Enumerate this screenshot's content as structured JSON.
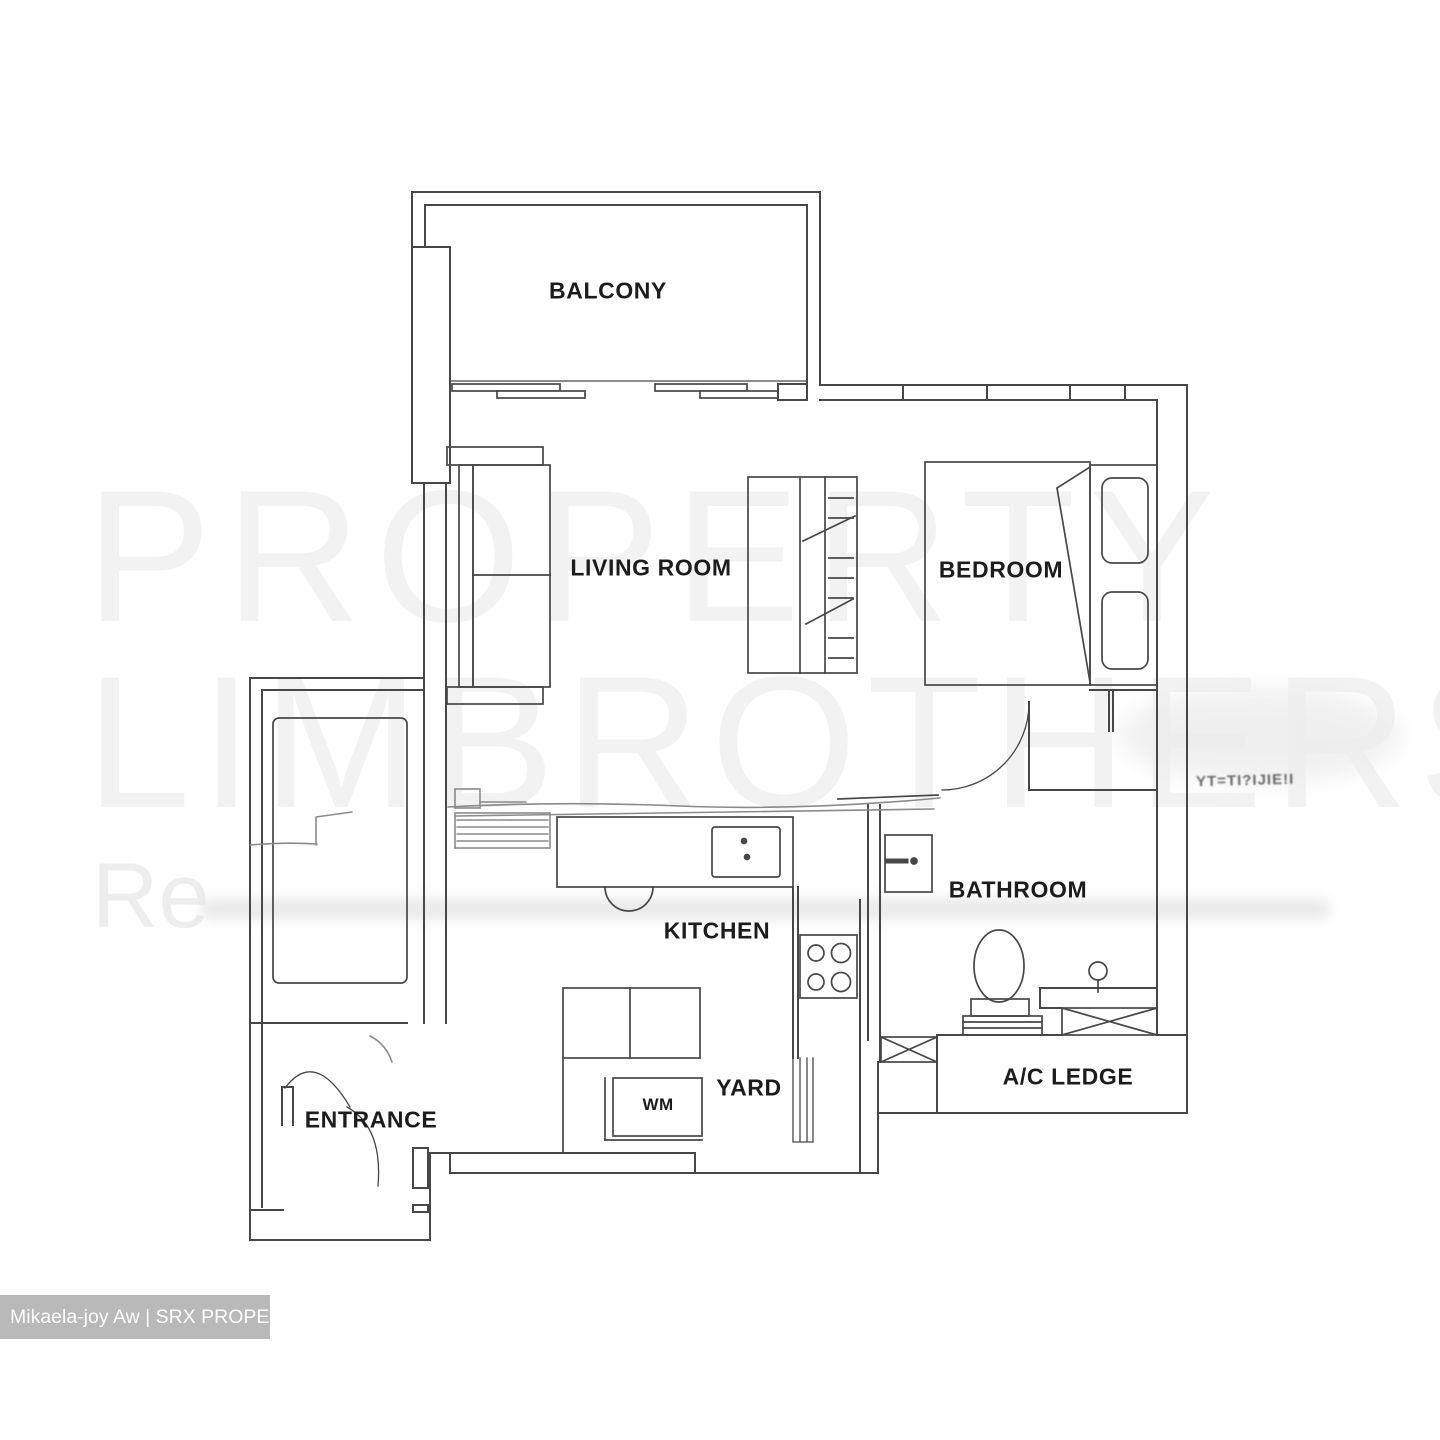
{
  "watermark": {
    "line1": "PROPERTY",
    "line2": "LIMBROTHERS",
    "line3": "Re"
  },
  "rooms": {
    "balcony": "BALCONY",
    "living_room": "LIVING ROOM",
    "bedroom": "BEDROOM",
    "kitchen": "KITCHEN",
    "bathroom": "BATHROOM",
    "yard": "YARD",
    "entrance": "ENTRANCE",
    "ac_ledge": "A/C LEDGE",
    "wm": "WM"
  },
  "credit": {
    "text": "Mikaela-joy Aw | SRX PROPERTY"
  },
  "noise": {
    "text": "YT=TI?IJIE!I"
  },
  "colors": {
    "line": "#474747",
    "sketch": "#8a8a8a",
    "label": "#1c1c1c",
    "watermark": "#f2f2f2",
    "creditbg": "#b9b9b9",
    "creditfg": "#fdfdfd",
    "noise": "#4e4e4e"
  }
}
